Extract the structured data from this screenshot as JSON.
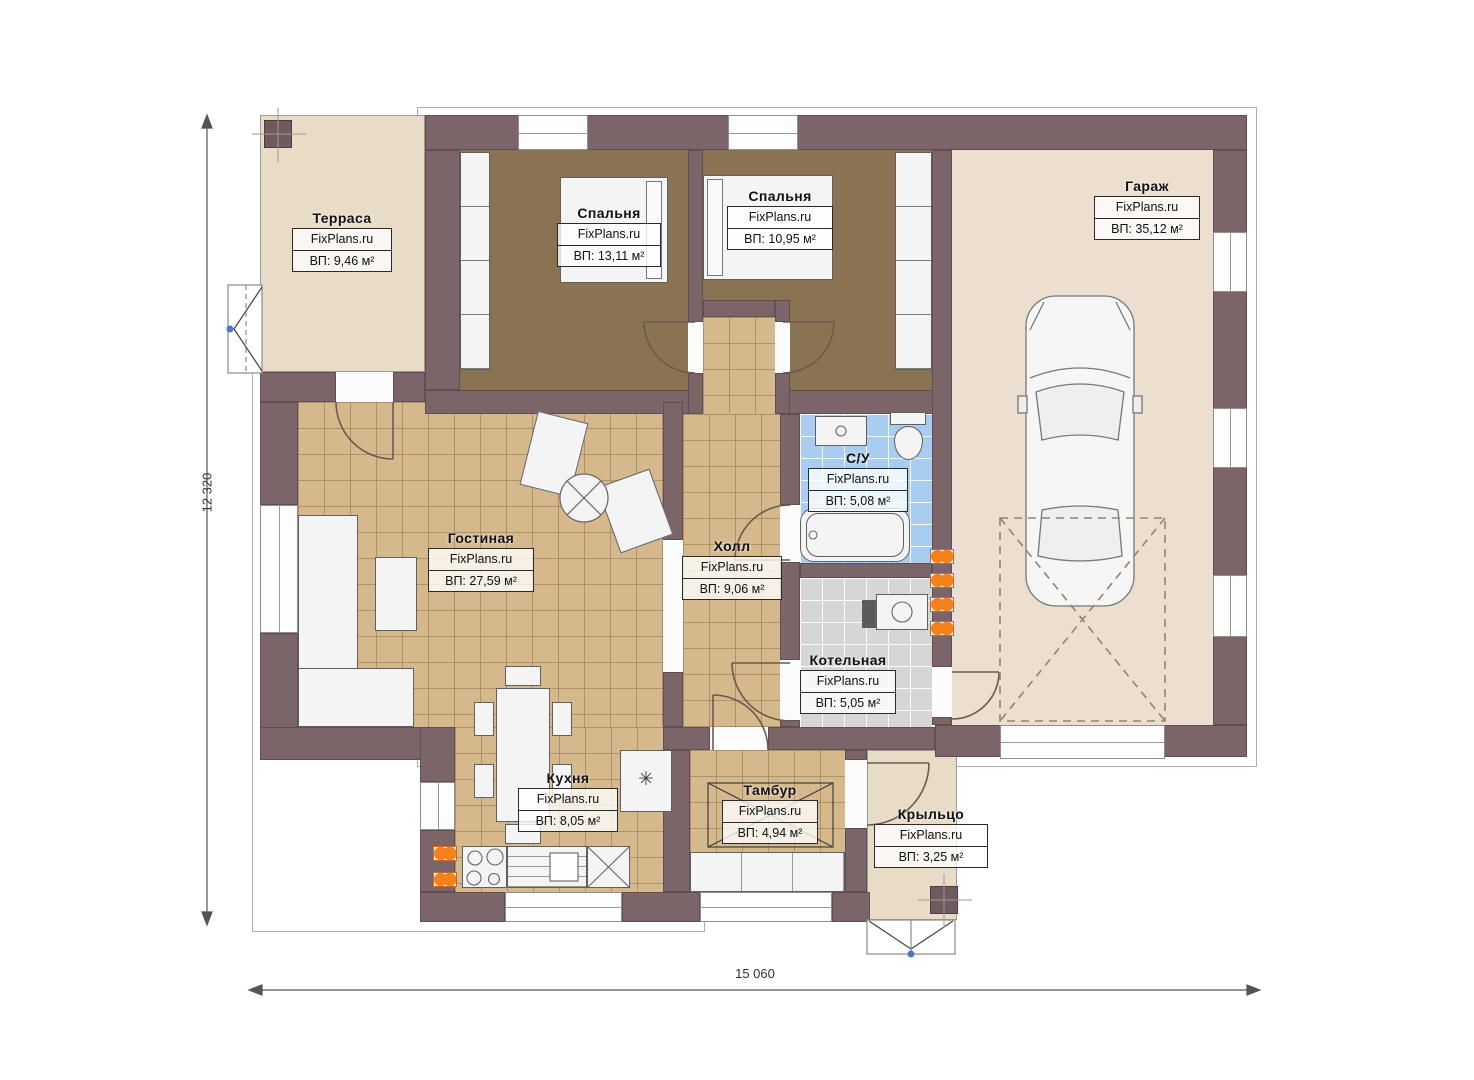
{
  "watermark": "FixPlans.ru",
  "dimensions": {
    "width_label": "15 060",
    "height_label": "12 320"
  },
  "rooms": {
    "terrace": {
      "name": "Терраса",
      "area": "ВП: 9,46 м²"
    },
    "bedroom1": {
      "name": "Спальня",
      "area": "ВП: 13,11 м²"
    },
    "bedroom2": {
      "name": "Спальня",
      "area": "ВП: 10,95 м²"
    },
    "garage": {
      "name": "Гараж",
      "area": "ВП: 35,12 м²"
    },
    "living": {
      "name": "Гостиная",
      "area": "ВП: 27,59 м²"
    },
    "hall": {
      "name": "Холл",
      "area": "ВП: 9,06 м²"
    },
    "bathroom": {
      "name": "С/У",
      "area": "ВП: 5,08 м²"
    },
    "boiler": {
      "name": "Котельная",
      "area": "ВП: 5,05 м²"
    },
    "kitchen": {
      "name": "Кухня",
      "area": "ВП: 8,05 м²"
    },
    "tambour": {
      "name": "Тамбур",
      "area": "ВП: 4,94 м²"
    },
    "porch": {
      "name": "Крыльцо",
      "area": "ВП: 3,25 м²"
    }
  },
  "symbols": {
    "appliance_symbol": "✳"
  },
  "colors": {
    "wall": "#7b6569",
    "floor_tile": "#d5b98c",
    "floor_bedroom": "#8a7352",
    "floor_bath": "#a9cdf0",
    "floor_boiler": "#d6d6d6",
    "floor_terrace": "#e9dcc7",
    "floor_garage": "#ecdfd0",
    "radiator": "#f5801e",
    "marker_dot": "#4a78c0"
  }
}
